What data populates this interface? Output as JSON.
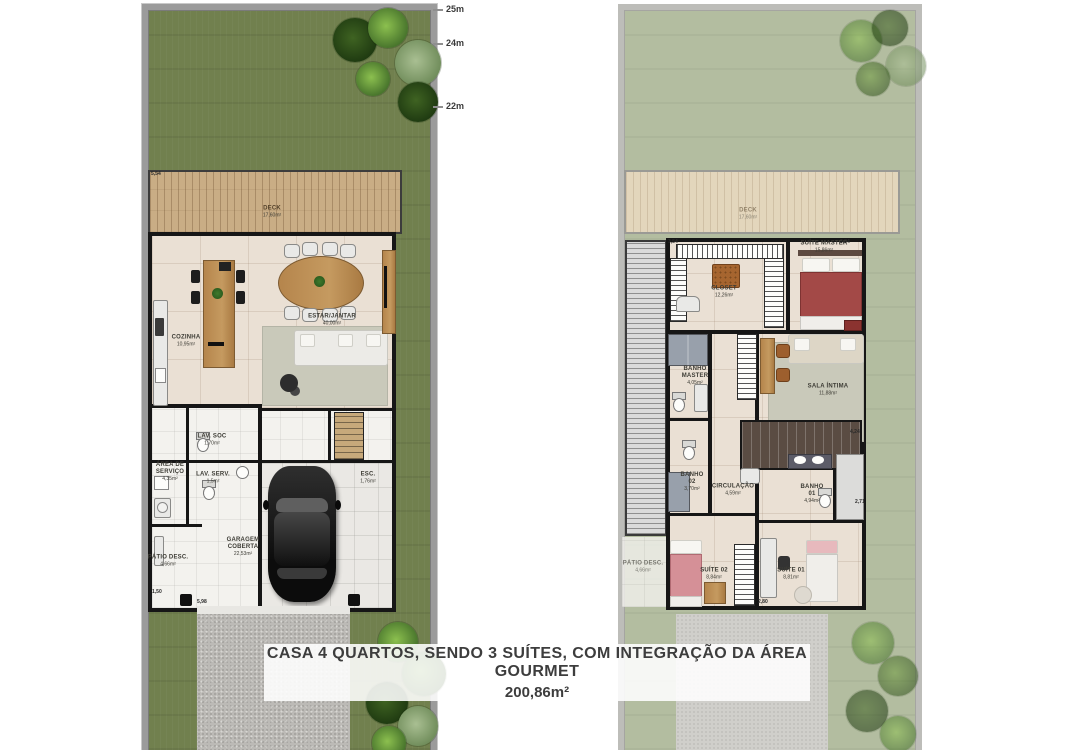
{
  "caption": {
    "line1": "CASA 4 QUARTOS, SENDO 3 SUÍTES, COM INTEGRAÇÃO DA ÁREA GOURMET",
    "line2": "200,86m²"
  },
  "ruler": {
    "m25": "25m",
    "m24": "24m",
    "m22": "22m"
  },
  "ground_floor": {
    "deck": {
      "name": "DECK",
      "area": "17,60m²"
    },
    "rooms": {
      "cozinha": {
        "name": "COZINHA",
        "area": "10,95m²"
      },
      "estar_jantar": {
        "name": "ESTAR/JANTAR",
        "area": "40,00m²"
      },
      "lav_soc": {
        "name": "LAV. SOC",
        "area": "1,70m²"
      },
      "area_servico": {
        "name": "ÁREA DE SERVIÇO",
        "area": "4,35m²"
      },
      "lav_serv": {
        "name": "LAV. SERV.",
        "area": "1,5m²"
      },
      "esc": {
        "name": "ESC.",
        "area": "1,76m²"
      },
      "garagem": {
        "name": "GARAGEM COBERTA",
        "area": "22,53m²"
      },
      "patio": {
        "name": "PÁTIO DESC.",
        "area": "4,66m²"
      }
    },
    "dims": {
      "d1": "5,54",
      "d2": "5,98",
      "d3": "1,50"
    }
  },
  "upper_floor": {
    "deck": {
      "name": "DECK",
      "area": "17,60m²"
    },
    "rooms": {
      "closet": {
        "name": "CLOSET",
        "area": "12,26m²"
      },
      "suite_master": {
        "name": "SUÍTE MASTER",
        "area": "15,86m²"
      },
      "banho_master": {
        "name": "BANHO MASTER",
        "area": "4,05m²"
      },
      "sala_intima": {
        "name": "SALA ÍNTIMA",
        "area": "11,88m²"
      },
      "banho02": {
        "name": "BANHO 02",
        "area": "3,70m²"
      },
      "circulacao": {
        "name": "CIRCULAÇÃO",
        "area": "4,59m²"
      },
      "banho01": {
        "name": "BANHO 01",
        "area": "4,94m²"
      },
      "suite02": {
        "name": "SUÍTE 02",
        "area": "8,84m²"
      },
      "suite01": {
        "name": "SUÍTE 01",
        "area": "8,81m²"
      },
      "patio": {
        "name": "PÁTIO DESC.",
        "area": "4,66m²"
      }
    },
    "dims": {
      "d1": "3,54",
      "d2": "3,84",
      "d3": "4,24",
      "d4": "2,71",
      "d5": "2,80"
    }
  },
  "colors": {
    "lawn": "#71804e",
    "lawn_faded": "#b3bda0",
    "deck": "#c9ad85",
    "boundary_wall": "#9b9b9b",
    "interior_wall": "#161616",
    "marble_floor": "#eae0d4",
    "wood": "#b5854c",
    "caption_text": "#3d3d3d"
  }
}
